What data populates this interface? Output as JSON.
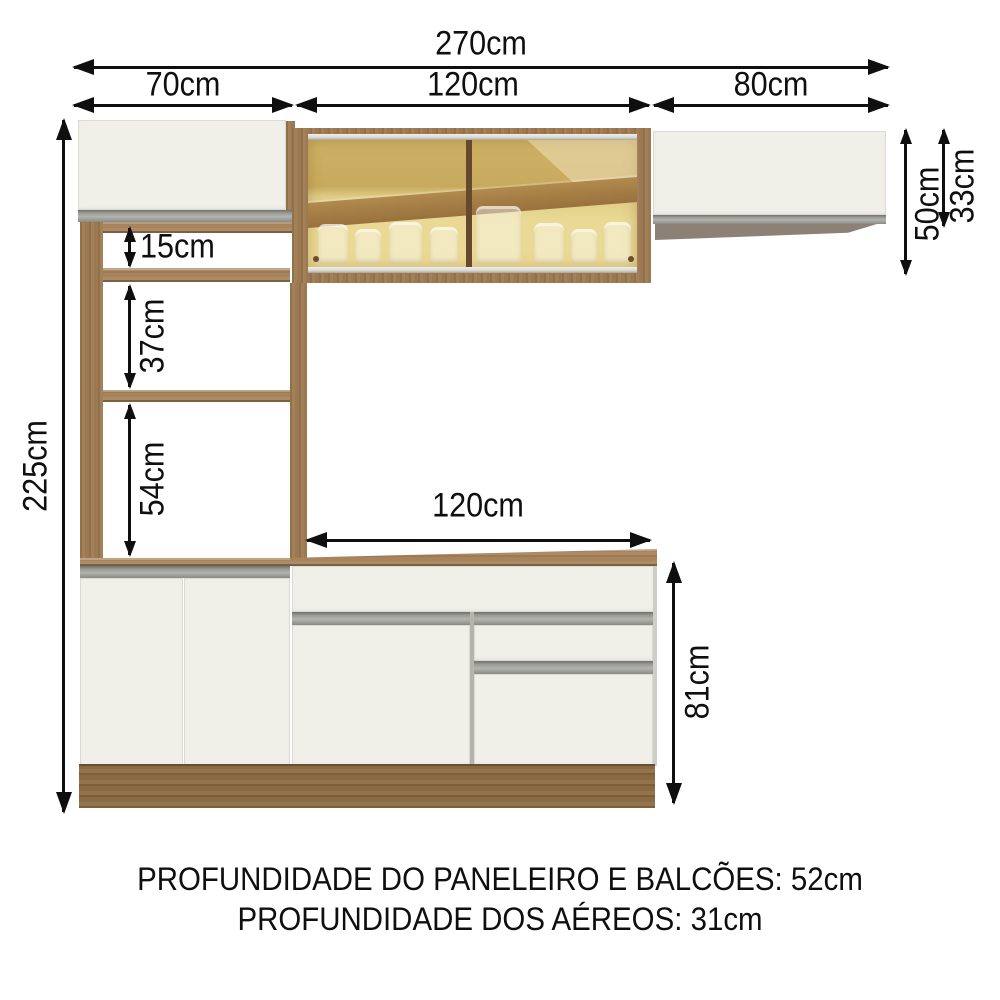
{
  "dims": {
    "total_width": "270cm",
    "left_section": "70cm",
    "middle_section": "120cm",
    "right_section": "80cm",
    "total_height": "225cm",
    "niche_top": "15cm",
    "niche_middle": "37cm",
    "niche_bottom": "54cm",
    "counter_width": "120cm",
    "counter_height": "81cm",
    "glass_aerial_height": "50cm",
    "right_aerial_height": "33cm"
  },
  "notes": {
    "depth_cabinets": "PROFUNDIDADE DO PANELEIRO E BALCÕES: 52cm",
    "depth_aerials": "PROFUNDIDADE DOS AÉREOS: 31cm"
  },
  "colors": {
    "wood": "#9c7950",
    "wood_dark": "#8b6a43",
    "panel_white": "#f0efe8",
    "handle_strip_gray": "#9a9a94",
    "glass_amber": "#d9c47e",
    "underside_taupe": "#8c8174",
    "dimension_lines": "#0f0f0f",
    "background": "#ffffff"
  }
}
